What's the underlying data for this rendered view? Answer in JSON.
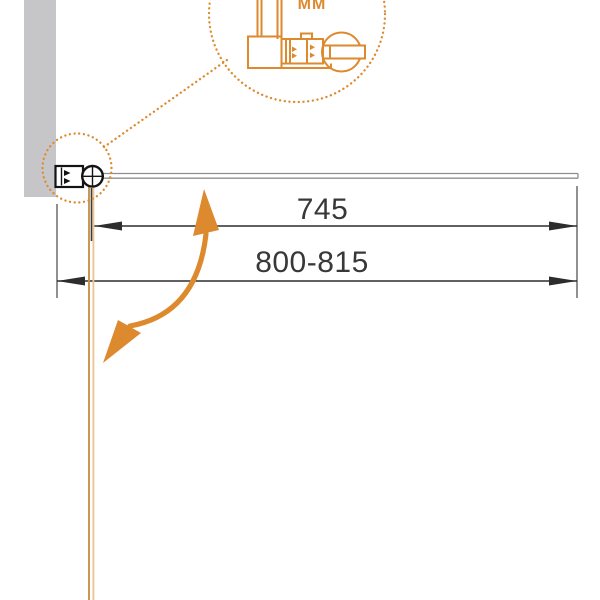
{
  "diagram": {
    "type": "shower-door-installation-drawing",
    "detail": {
      "unit_label": "MM"
    },
    "dimensions": {
      "glass_width": "745",
      "installation_width": "800-815"
    },
    "colors": {
      "accent": "#DD8A2E",
      "wall": "#C6C6C8",
      "door_dark": "#C4924E",
      "door_light": "#EBC697",
      "dimension_line": "#2D2D2D",
      "dimension_text": "#383838",
      "glass_edge": "#8E8E92",
      "hinge_black": "#141414"
    }
  }
}
